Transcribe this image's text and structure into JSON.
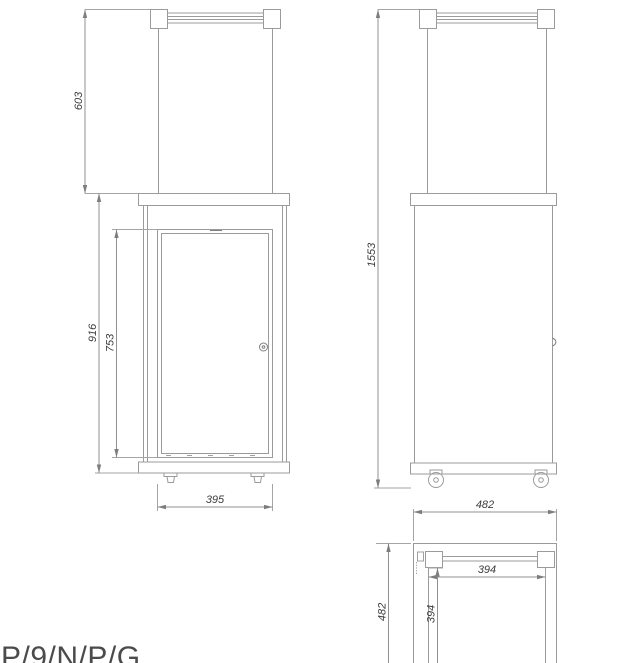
{
  "drawing": {
    "type": "technical-dimension-drawing",
    "background": "#ffffff",
    "colors": {
      "line": "#9b9b9b",
      "dimension_line": "#909090",
      "text": "#3c3c3c"
    },
    "views": {
      "front": {
        "dims": {
          "glass_section_height": "603",
          "body_height": "916",
          "door_height": "753",
          "width": "395"
        }
      },
      "side": {
        "dims": {
          "total_height": "1553"
        }
      },
      "top": {
        "dims": {
          "outer_width": "482",
          "inner_width": "394",
          "outer_depth": "482",
          "inner_depth": "394"
        }
      }
    },
    "footer": {
      "model_label": "P/9/N/P/G"
    }
  }
}
